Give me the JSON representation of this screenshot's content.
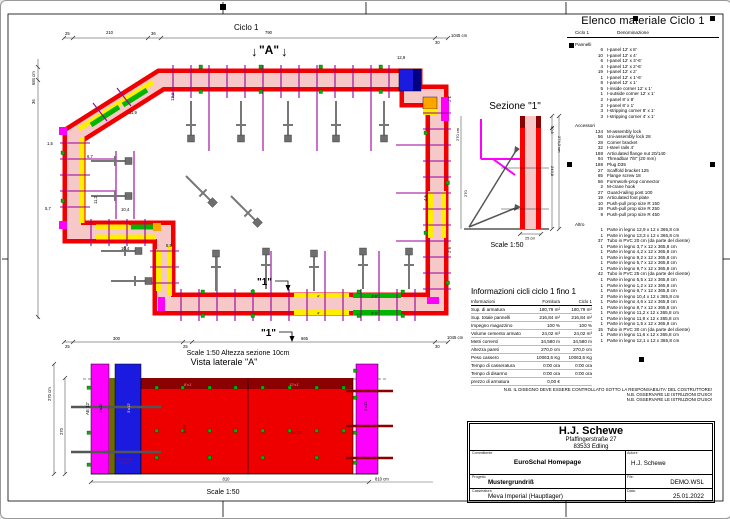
{
  "colors": {
    "formwork_red": "#f00000",
    "concrete_pink": "#f6c8c8",
    "top_panel_darkred": "#8b0000",
    "panel_magenta": "#ff00ff",
    "panel_blue": "#1b1bdf",
    "panel_navy": "#000080",
    "panel_yellow": "#ffee00",
    "panel_green": "#00b400",
    "panel_orange": "#ffa500",
    "tie_purple": "#990099",
    "prop_gray": "#777777",
    "wood_olive": "#6b6b00"
  },
  "plan": {
    "title": "Ciclo 1",
    "marker_a_arrow_l": "↓",
    "marker_a": "\"A\"",
    "marker_a_arrow_r": "↓",
    "marker_1a": "\"1\"",
    "marker_1b": "\"1\"",
    "scale_note": "Scale 1:50   Altezza sezione 10cm",
    "dims": {
      "top": [
        "25",
        "210",
        "36",
        "790",
        "30",
        "1045 cm"
      ],
      "bottom": [
        "25",
        "300",
        "25",
        "665",
        "30",
        "1045 cm"
      ],
      "left_total": "684 cm",
      "left_seg": "36"
    },
    "labels": {
      "l129": "12,9",
      "l37": "3,7",
      "l119": "11,9",
      "l15": "1,5",
      "l67": "6,7",
      "l57": "5,7",
      "l112": "11,2",
      "l104a": "10,4",
      "l104b": "10,4",
      "l55": "5,5",
      "l92": "9,2",
      "l121": "12,1",
      "l46": "4,6",
      "seg4a": "4'",
      "seg4b": "4'",
      "seg36a": "3'-6'",
      "seg36b": "3'-6'"
    }
  },
  "side_view": {
    "title": "Vista laterale \"A\"",
    "scale": "Scale 1:50",
    "dim_height_total": "270 cm",
    "dim_height": "270",
    "dim_width": "810",
    "dim_width_total": "810 cm",
    "label_ae": "AE 12'",
    "label_magenta_left": "2'x12'",
    "label_blue": "3'x12'",
    "label_strip_8": "8'x1'",
    "label_strip_12": "12'x1'",
    "label_body_8": "8'x8'",
    "label_body_12": "12'x8'",
    "label_magenta_right": "2'x12'",
    "wood_note_1": "Parte in legno",
    "wood_note_2": "13,3 x 12"
  },
  "sezione": {
    "title": "Sezione \"1\"",
    "scale": "Scale 1:50",
    "dim_top": "30,5",
    "dim_total": "274,3 cm",
    "dim_body": "243,8",
    "dim_left_total": "270 cm",
    "dim_left": "270",
    "dim_thickness": "25 cm"
  },
  "info_table": {
    "title": "Informazioni cicli  ciclo 1 fino 1",
    "col_headers": [
      "Informazioni",
      "Fornitura",
      "Ciclo 1"
    ],
    "rows": [
      {
        "label": "Sup. di armatura",
        "fornitura": "180,79 m²",
        "ciclo": "180,79 m²"
      },
      {
        "label": "Sup. totale pannelli",
        "fornitura": "216,84 m²",
        "ciclo": "216,84 m²"
      },
      {
        "label": "Impegno magazzino",
        "fornitura": "100 %",
        "ciclo": "100 %"
      },
      {
        "label": "Volume cemento armato",
        "fornitura": "24,02 m³",
        "ciclo": "24,02 m³"
      },
      {
        "label": "Metri correnti",
        "fornitura": "34,580 m",
        "ciclo": "34,580 m"
      },
      {
        "label": "Altezza pareti",
        "fornitura": "270,0 cm",
        "ciclo": "270,0 cm"
      },
      {
        "label": "Peso cassero",
        "fornitura": "10063,5 Kg",
        "ciclo": "10063,5 Kg"
      },
      {
        "label": "Tempo di casseratura",
        "fornitura": "0:00 ora",
        "ciclo": "0:00 ora"
      },
      {
        "label": "Tempo di disarmo",
        "fornitura": "0:00 ora",
        "ciclo": "0:00 ora"
      },
      {
        "label": "prezzo di armatura",
        "fornitura": "0,00 €",
        "ciclo": ""
      }
    ]
  },
  "material_list": {
    "title": "Elenco materiale  Ciclo 1",
    "header_qty": "Ciclo 1",
    "header_name": "Denominazione",
    "sections": [
      {
        "name": "Pannelli",
        "items": [
          [
            "6",
            "I-panel 12' x 8'"
          ],
          [
            "10",
            "I-panel 12' x 4'"
          ],
          [
            "6",
            "I-panel 12' x 3'-6'"
          ],
          [
            "4",
            "I-panel 12' x 2'-6'"
          ],
          [
            "19",
            "I-panel 12' x 2'"
          ],
          [
            "1",
            "I-panel 12' x 1'-6'"
          ],
          [
            "8",
            "I-panel 12' x 1'"
          ],
          [
            "5",
            "I-inside corner 12' x 1'"
          ],
          [
            "1",
            "I-outside corner 12' x 1'"
          ],
          [
            "2",
            "I-panel 8' x 8'"
          ],
          [
            "2",
            "I-panel 8' x 1'"
          ],
          [
            "3",
            "I-stripping corner 8' x 1'"
          ],
          [
            "3",
            "I-stripping corner 4' x 1'"
          ]
        ]
      },
      {
        "name": "Accessori",
        "items": [
          [
            "134",
            "M-assembly lock"
          ],
          [
            "56",
            "Uni-assembly lock 28"
          ],
          [
            "28",
            "Corner bracket"
          ],
          [
            "32",
            "I-steel rails 4'"
          ],
          [
            "188",
            "Articulated flange nut 20/140"
          ],
          [
            "94",
            "Threadbar 7/8\" (20 mm)"
          ],
          [
            "188",
            "Plug D35"
          ],
          [
            "27",
            "Scaffold bracket 125"
          ],
          [
            "65",
            "Flange screw 18"
          ],
          [
            "56",
            "Formwork-prop connector"
          ],
          [
            "2",
            "M-crane hook"
          ],
          [
            "27",
            "Guard-railing post 100"
          ],
          [
            "19",
            "Articulated foot plate"
          ],
          [
            "10",
            "Push-pull prop size R 150"
          ],
          [
            "19",
            "Push-pull prop size R 250"
          ],
          [
            "9",
            "Push-pull prop size R 450"
          ]
        ]
      },
      {
        "name": "Altro",
        "items": [
          [
            "1",
            "Parte in legno 12,9 x 12 x 365,8 cm"
          ],
          [
            "1",
            "Parte in legno 13,3 x 12 x 365,8 cm"
          ],
          [
            "37",
            "Tubo in PVC 20 cm (da parte del cliente)"
          ],
          [
            "1",
            "Parte in legno 3,7 x 12 x 365,8 cm"
          ],
          [
            "1",
            "Parte in legno 4,2 x 12 x 365,8 cm"
          ],
          [
            "1",
            "Parte in legno 9,2 x 12 x 365,8 cm"
          ],
          [
            "1",
            "Parte in legno 5,7 x 12 x 365,8 cm"
          ],
          [
            "1",
            "Parte in legno 9,7 x 12 x 365,8 cm"
          ],
          [
            "42",
            "Tubo in PVC 25 cm (da parte del cliente)"
          ],
          [
            "1",
            "Parte in legno 5,5 x 12 x 365,8 cm"
          ],
          [
            "1",
            "Parte in legno 1,2 x 12 x 365,8 cm"
          ],
          [
            "1",
            "Parte in legno 6,7 x 12 x 365,8 cm"
          ],
          [
            "2",
            "Parte in legno 10,4 x 12 x 365,8 cm"
          ],
          [
            "1",
            "Parte in legno 4,6 x 12 x 365,8 cm"
          ],
          [
            "1",
            "Parte in legno 8,7 x 12 x 365,8 cm"
          ],
          [
            "1",
            "Parte in legno 11,2 x 12 x 365,8 cm"
          ],
          [
            "1",
            "Parte in legno 11,9 x 12 x 365,8 cm"
          ],
          [
            "1",
            "Parte in legno 1,5 x 12 x 365,8 cm"
          ],
          [
            "15",
            "Tubo in PVC 30 cm (da parte del cliente)"
          ],
          [
            "1",
            "Parte in legno 11,6 x 12 x 365,8 cm"
          ],
          [
            "1",
            "Parte in legno 12,1 x 12 x 365,8 cm"
          ]
        ]
      }
    ]
  },
  "notes": [
    "N.B. IL DISEGNO DEVE ESSERE CONTROLLATO SOTTO LA RESPONSABILITA' DEL COSTRUTTORE!",
    "N.B. OSSERVARE LE ISTRUZIONI D'USO!",
    "N.B. OSSERVARE LE ISTRUZIONI D'USO!"
  ],
  "title_block": {
    "company_name": "H.J. Schewe",
    "company_street": "Pfaffingerstraße 27",
    "company_city": "83533 Edling",
    "client_label": "Committente",
    "client": "EuroSchal Homepage",
    "author_label": "Autore",
    "author": "H.J. Schewe",
    "project_label": "Progetto",
    "project": "Mustergrundriß",
    "file_label": "File:",
    "file": "DEMO.WSL",
    "formwork_label": "Casseratura",
    "formwork": "Meva Imperial (Hauptlager)",
    "date_label": "Data:",
    "date": "25.01.2022"
  }
}
